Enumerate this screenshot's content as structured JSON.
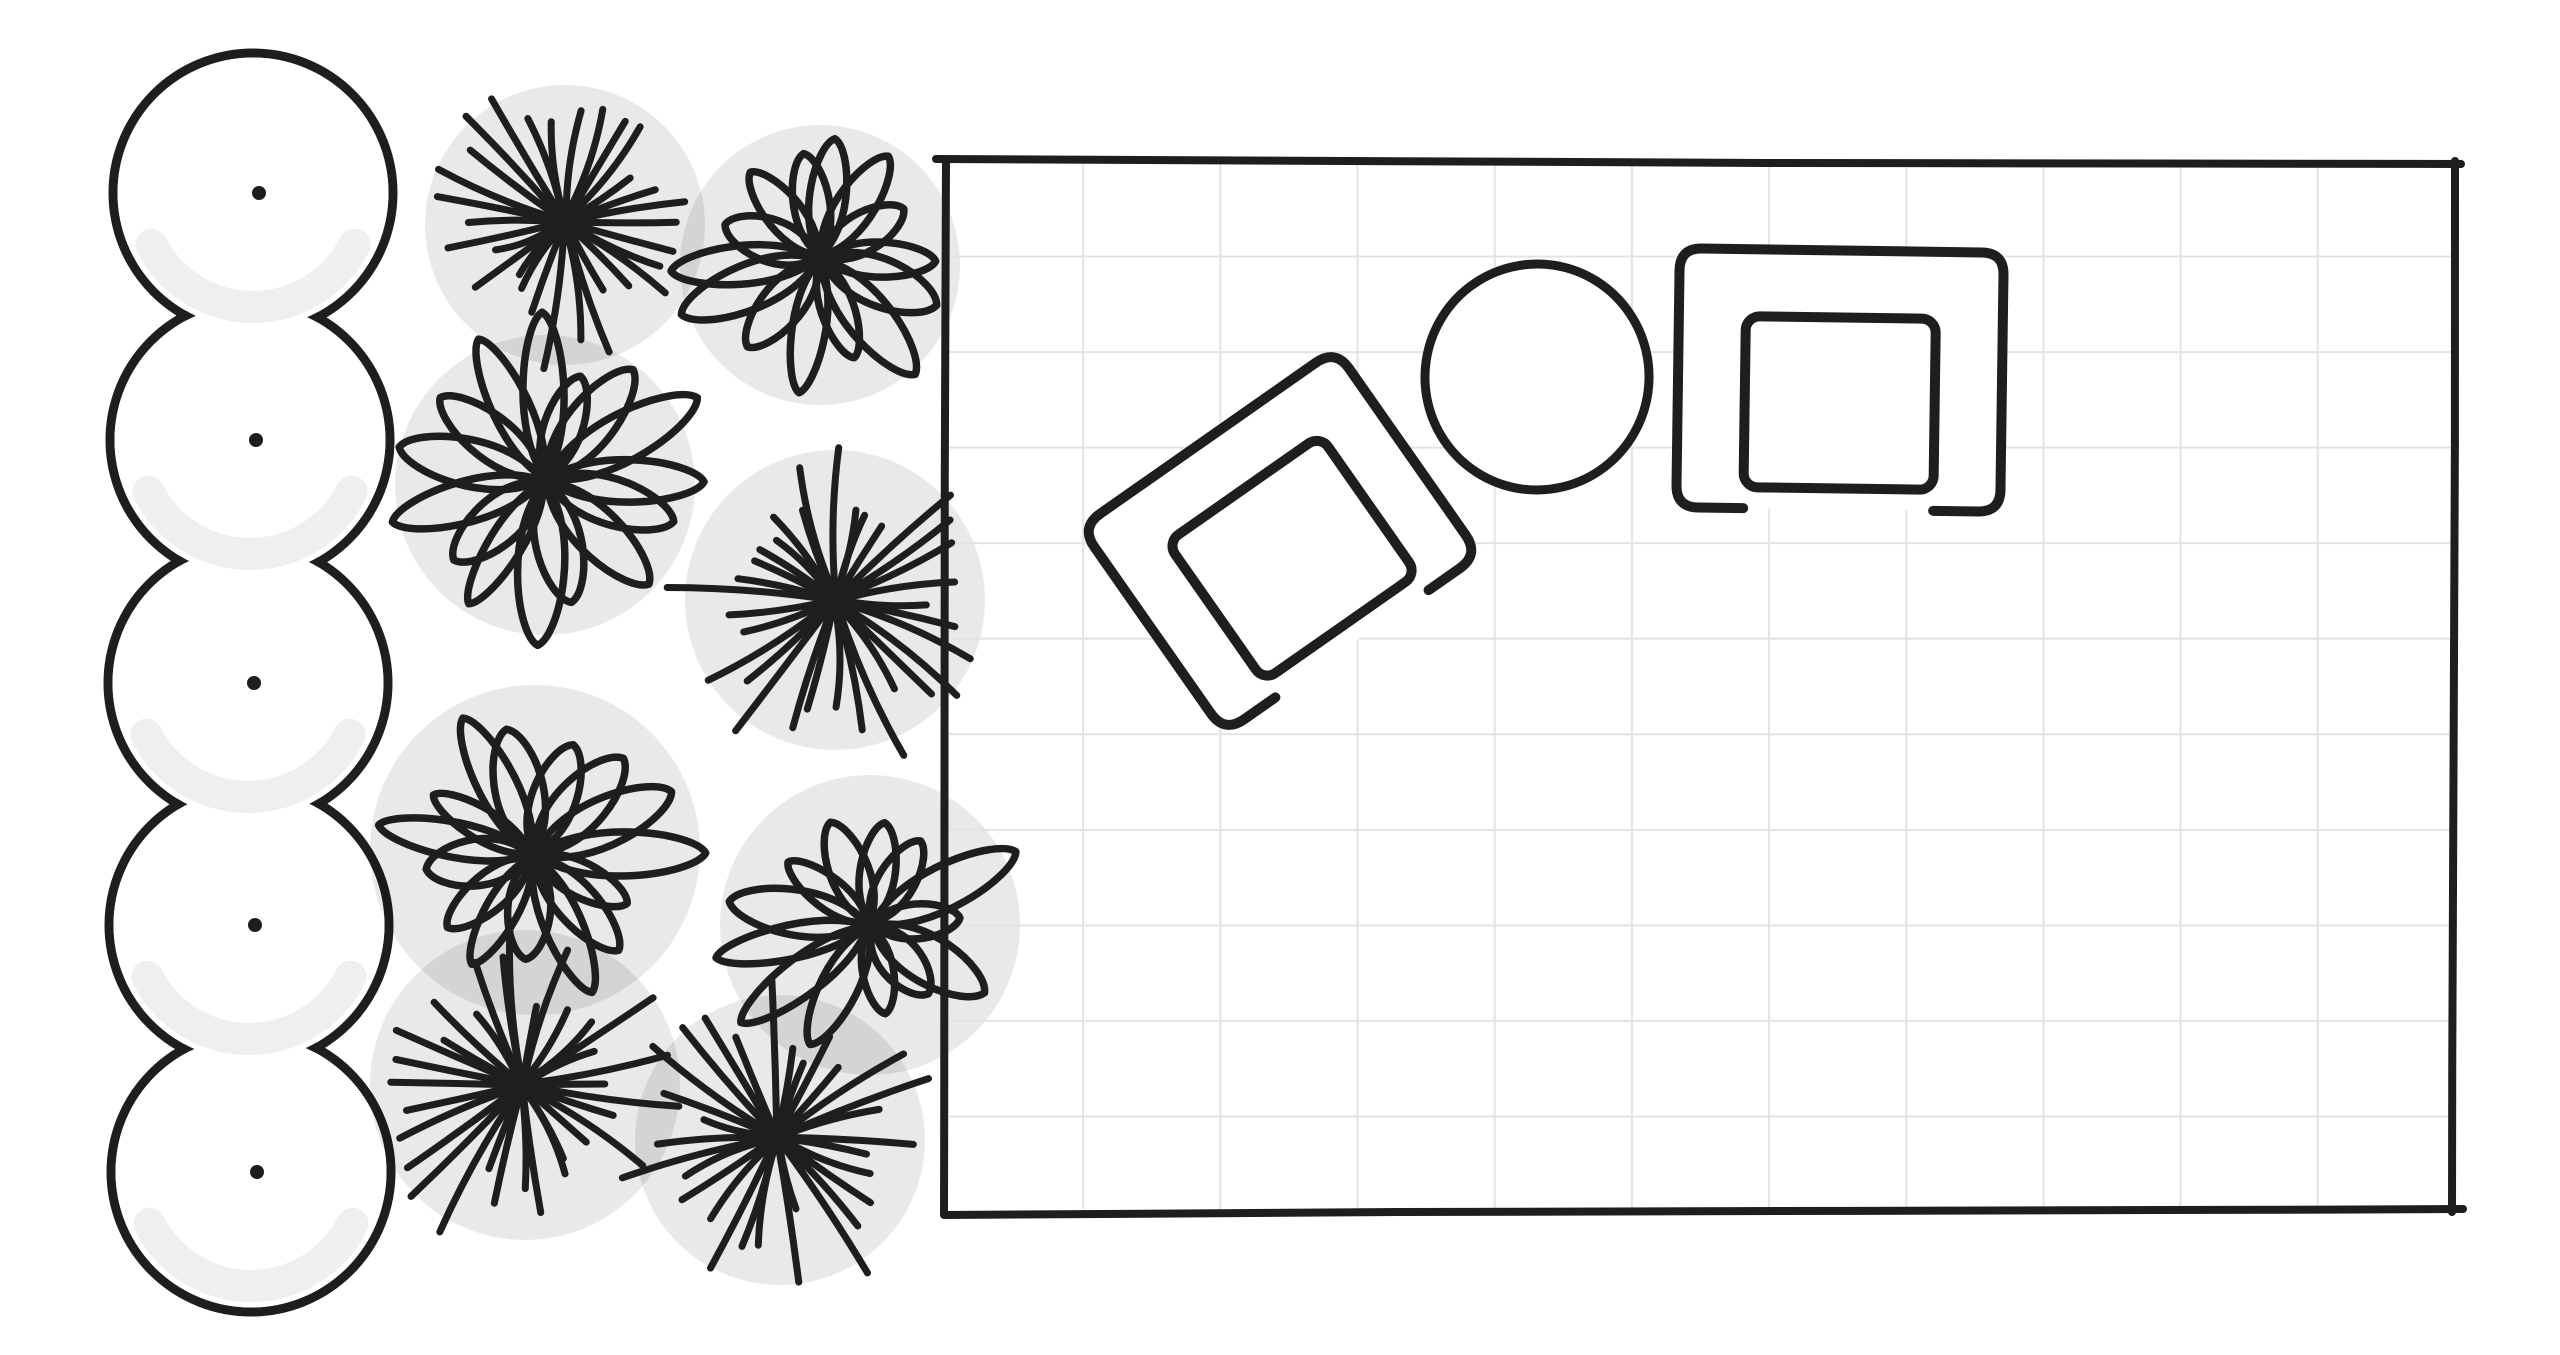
{
  "scene": {
    "width": 2560,
    "height": 1355,
    "background_color": "#ffffff",
    "ink_color": "#1e1e1e",
    "canopy_shade_color": "rgba(0,0,0,0.088)",
    "tree_shade_color": "#efefef",
    "grid_color": "#e3e3e3"
  },
  "tree_row": {
    "count": 5,
    "radius": 140,
    "stroke_width": 9,
    "dot_radius": 7,
    "shade_arc_width": 32,
    "trees": [
      {
        "cx": 253,
        "cy": 193
      },
      {
        "cx": 250,
        "cy": 440
      },
      {
        "cx": 248,
        "cy": 683
      },
      {
        "cx": 249,
        "cy": 925
      },
      {
        "cx": 251,
        "cy": 1172
      }
    ]
  },
  "shrub_bed": {
    "ray_stroke_width": 7,
    "petal_stroke_width": 7.5,
    "canopies": [
      {
        "cx": 565,
        "cy": 225,
        "r": 140
      },
      {
        "cx": 820,
        "cy": 265,
        "r": 140
      },
      {
        "cx": 545,
        "cy": 485,
        "r": 150
      },
      {
        "cx": 835,
        "cy": 600,
        "r": 150
      },
      {
        "cx": 535,
        "cy": 850,
        "r": 165
      },
      {
        "cx": 870,
        "cy": 925,
        "r": 150
      },
      {
        "cx": 525,
        "cy": 1085,
        "r": 155
      },
      {
        "cx": 780,
        "cy": 1140,
        "r": 145
      }
    ],
    "plants": [
      {
        "type": "starburst",
        "cx": 565,
        "cy": 222,
        "r": 150,
        "rays": 30,
        "seed": 11
      },
      {
        "type": "flower",
        "cx": 820,
        "cy": 258,
        "r": 178,
        "petals": 14,
        "seed": 22
      },
      {
        "type": "flower",
        "cx": 545,
        "cy": 480,
        "r": 182,
        "petals": 15,
        "seed": 33
      },
      {
        "type": "starburst",
        "cx": 835,
        "cy": 600,
        "r": 170,
        "rays": 32,
        "seed": 44
      },
      {
        "type": "flower",
        "cx": 533,
        "cy": 855,
        "r": 185,
        "petals": 15,
        "seed": 55
      },
      {
        "type": "flower",
        "cx": 870,
        "cy": 925,
        "r": 165,
        "petals": 13,
        "seed": 66
      },
      {
        "type": "starburst",
        "cx": 522,
        "cy": 1085,
        "r": 175,
        "rays": 32,
        "seed": 77
      },
      {
        "type": "starburst",
        "cx": 777,
        "cy": 1137,
        "r": 165,
        "rays": 30,
        "seed": 88
      }
    ]
  },
  "room": {
    "x": 946,
    "y": 161,
    "width": 1509,
    "height": 1051,
    "stroke_width": 8,
    "grid": {
      "columns": 11,
      "rows": 11,
      "line_width": 2
    }
  },
  "furniture": {
    "sofa_angled": {
      "cx": 1280,
      "cy": 541,
      "width": 311,
      "height": 251,
      "band": 62,
      "seat_gap": 20,
      "corner_radius": 24,
      "rotation_deg": -35,
      "stroke_width": 10
    },
    "sofa_straight": {
      "cx": 1840,
      "cy": 380,
      "width": 324,
      "height": 259,
      "band": 67,
      "seat_gap": 21,
      "corner_radius": 22,
      "rotation_deg": 0.8,
      "stroke_width": 10
    },
    "round_table": {
      "cx": 1537,
      "cy": 377,
      "rx": 112,
      "ry": 113,
      "rotation_deg": 8,
      "stroke_width": 9
    }
  }
}
